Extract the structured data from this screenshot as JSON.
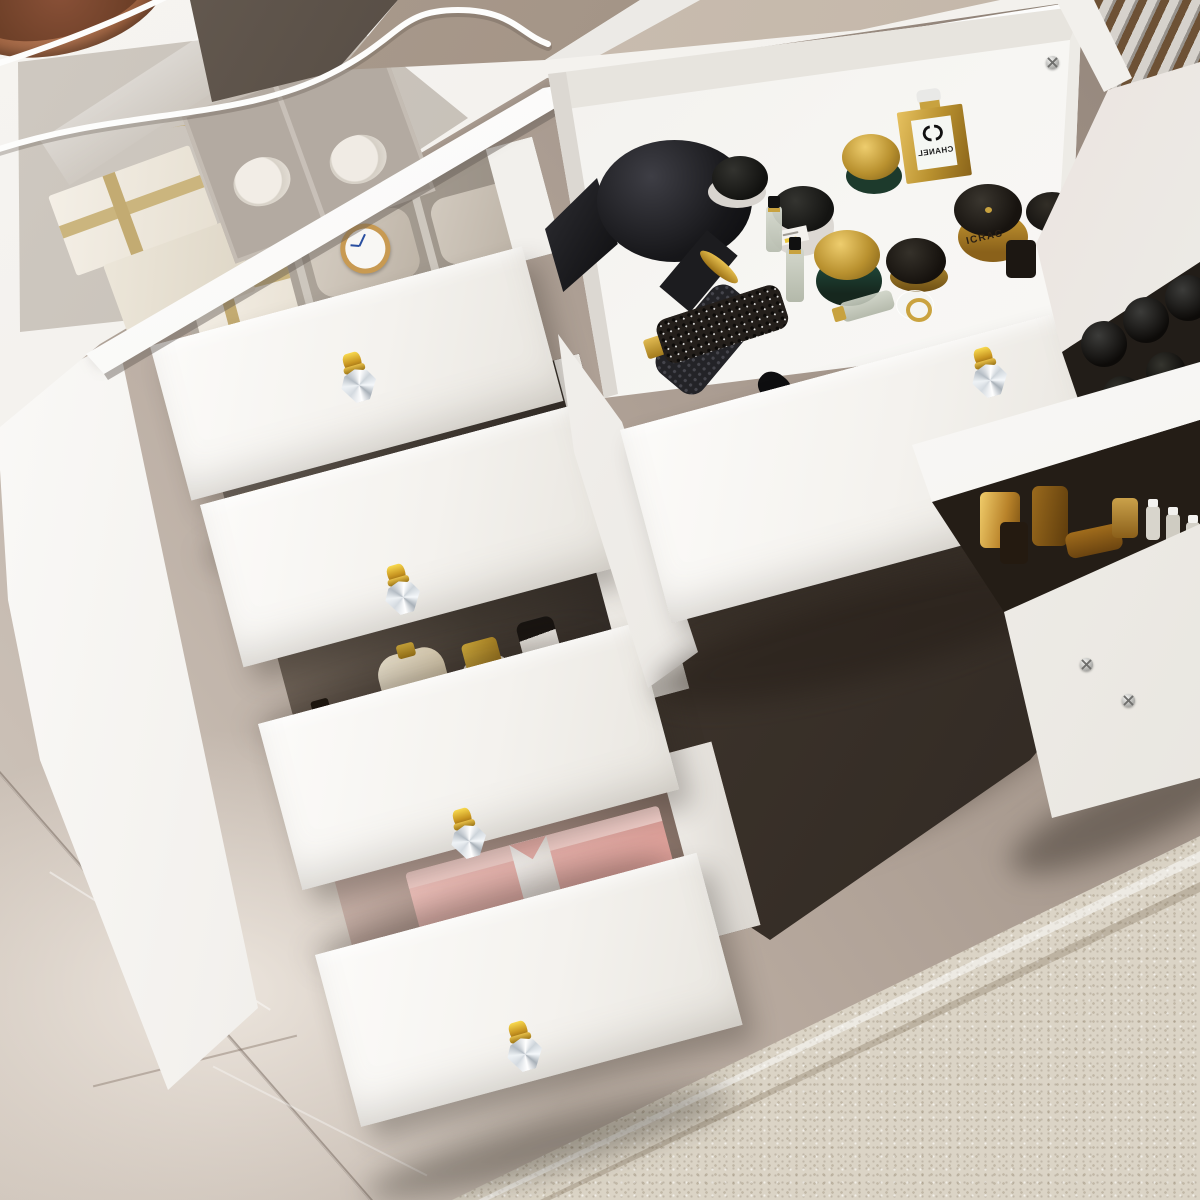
{
  "scene": {
    "description": "3D product render: white vanity dressing table with tempered glass display top, nine drawers pulled open in a cascade revealing cosmetics, perfumes, a black hair dryer, a hair brush, a wrist watch and gift boxes; crystal knobs with gold bases; grey-taupe marble floor, dark floor under the desk and a beige speckled rug at lower right; white power cable and a copper tray on the glass top",
    "labels": {
      "chanel": {
        "text": "CHANEL",
        "logo_icon": "interlocked-cc",
        "mirrored": true
      },
      "gold_jar": {
        "text": "ICRAC"
      }
    },
    "visible_text": [
      "CHANEL",
      "ICRAC"
    ],
    "counts": {
      "left_drawers_open": 4,
      "center_drawer_open": 1,
      "right_drawers_open": 4,
      "crystal_knobs_visible": 5
    },
    "colors": {
      "desk_white": "#f4f2ee",
      "desktop_edge": "#ffffff",
      "floor_marble_light": "#cfc4ba",
      "floor_marble_dark": "#9a8c80",
      "floor_under_desk": "#3d342c",
      "carpet": "#dbd4c6",
      "knob_gold": "#d9a62e",
      "knob_crystal": "#eef1f4",
      "felt_tray_grey": "#a89f95",
      "gift_box_cream": "#f3eee5",
      "ribbon_gold": "#cbb57e",
      "gift_box_pink": "#eebcb6",
      "ribbon_white": "#f7f3ef",
      "jar_green": "#1d3a2c",
      "jar_gold": "#b9912f",
      "lid_black": "#17130f",
      "lid_gold_dome": "#d4af4e",
      "hair_dryer_black": "#17171a",
      "watch_case_gold": "#c89a52",
      "watch_dial": "#f8f7f4",
      "watch_hands_blue": "#2a4fa0",
      "copper_tray": "#a96f52",
      "under_glass_brown": "#a5968a"
    },
    "objects": [
      "glass-top-display-case",
      "under-glass-gift-boxes",
      "under-glass-organizer-with-towels",
      "dark-display-compartment",
      "white-power-cable",
      "copper-tray",
      "watch-drawer-with-pillows",
      "wrist-watch",
      "perfume-collection-drawer",
      "skincare-bottles-drawer",
      "cream-pump-bottle",
      "pink-gift-box-drawer",
      "center-drawer",
      "hair-dryer",
      "hair-brush",
      "chanel-perfume-bottle",
      "green-gold-cream-jars",
      "gold-icrac-jar",
      "perfume-vials",
      "right-pedestal-drawers",
      "black-bottle-caps",
      "amber-bottles",
      "crystal-drawer-knobs",
      "marble-floor",
      "beige-carpet"
    ]
  }
}
